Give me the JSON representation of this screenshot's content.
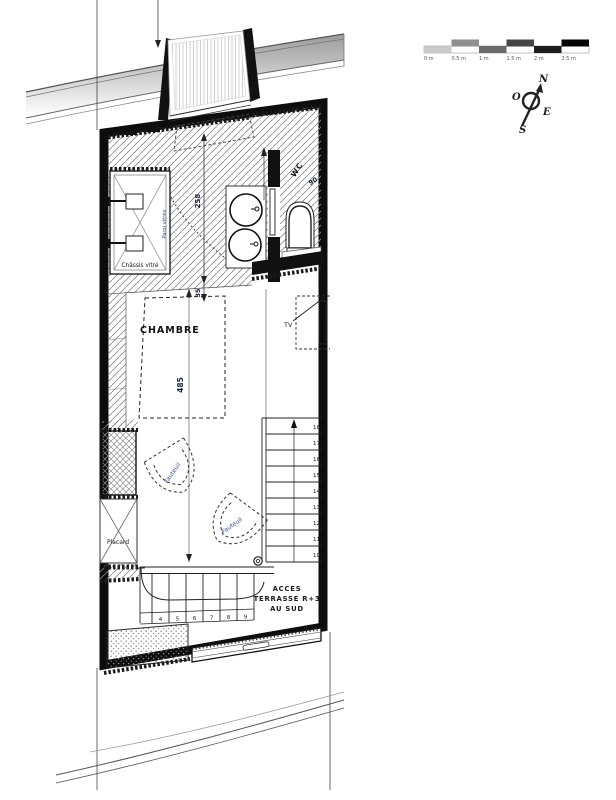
{
  "scale_bar": {
    "labels": [
      "0 m",
      "0.5 m",
      "1 m",
      "1.5 m",
      "2 m",
      "2.5 m"
    ],
    "segment_colors": [
      "#c9c9c9",
      "#8f8f8f",
      "#6a6a6a",
      "#454545",
      "#1d1d1d",
      "#000000"
    ]
  },
  "compass": {
    "north": "N",
    "west": "O",
    "east": "E",
    "south": "S"
  },
  "plan": {
    "rooms": {
      "chambre": "CHAMBRE",
      "wc": "WC",
      "placard": "Placard"
    },
    "features": {
      "chassis_vitre": "Châssis vitré",
      "paroi_vitree": "Paroi vitrée",
      "tv": "TV",
      "fauteuil": "Fauteuil"
    },
    "annotations": {
      "acces": "ACCES",
      "terrasse": "TERRASSE R+3",
      "au_sud": "AU SUD"
    },
    "dimensions": {
      "d258": "258",
      "d35": "35",
      "d485": "485",
      "d90": "90"
    },
    "stairs": {
      "upper": [
        "10",
        "11",
        "12",
        "13",
        "14",
        "15",
        "16",
        "17",
        "18"
      ],
      "lower": [
        "4",
        "5",
        "6",
        "7",
        "8",
        "9"
      ]
    }
  },
  "colors": {
    "wall": "#111111",
    "annotation_blue": "#32508c",
    "hatch": "#8a8a8a"
  }
}
